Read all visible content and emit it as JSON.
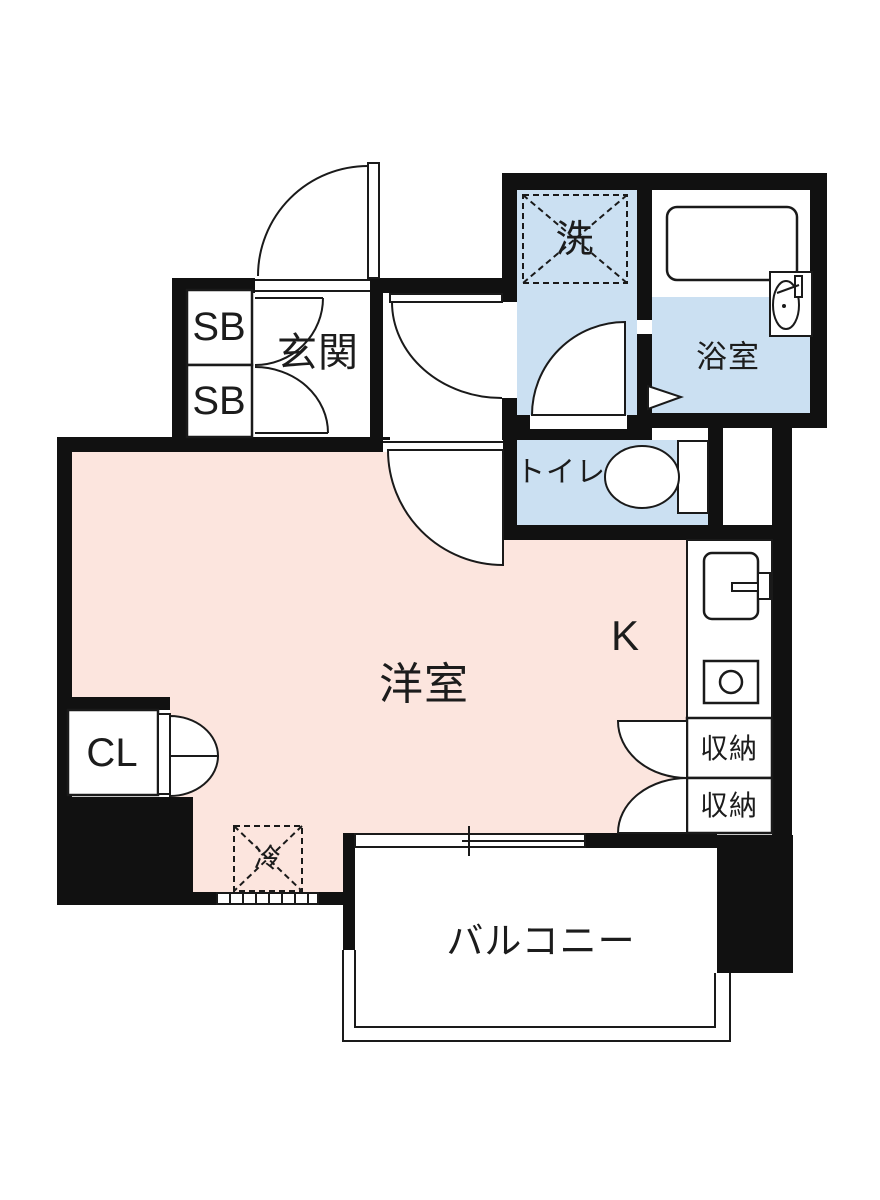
{
  "floorplan": {
    "labels": {
      "entrance": {
        "text": "玄関"
      },
      "shoe_box_top": {
        "text": "SB"
      },
      "shoe_box_bottom": {
        "text": "SB"
      },
      "washer": {
        "text": "洗"
      },
      "bathroom": {
        "text": "浴室"
      },
      "toilet": {
        "text": "トイレ"
      },
      "western_room": {
        "text": "洋室"
      },
      "kitchen": {
        "text": "K"
      },
      "storage_top": {
        "text": "収納"
      },
      "storage_bottom": {
        "text": "収納"
      },
      "closet": {
        "text": "CL"
      },
      "refrigerator": {
        "text": "冷"
      },
      "balcony": {
        "text": "バルコニー"
      }
    },
    "colors": {
      "wall": "#111111",
      "line": "#1a1a1a",
      "room_pink": "#fce5de",
      "wet_area_blue": "#cbe0f2",
      "background": "#ffffff"
    }
  }
}
